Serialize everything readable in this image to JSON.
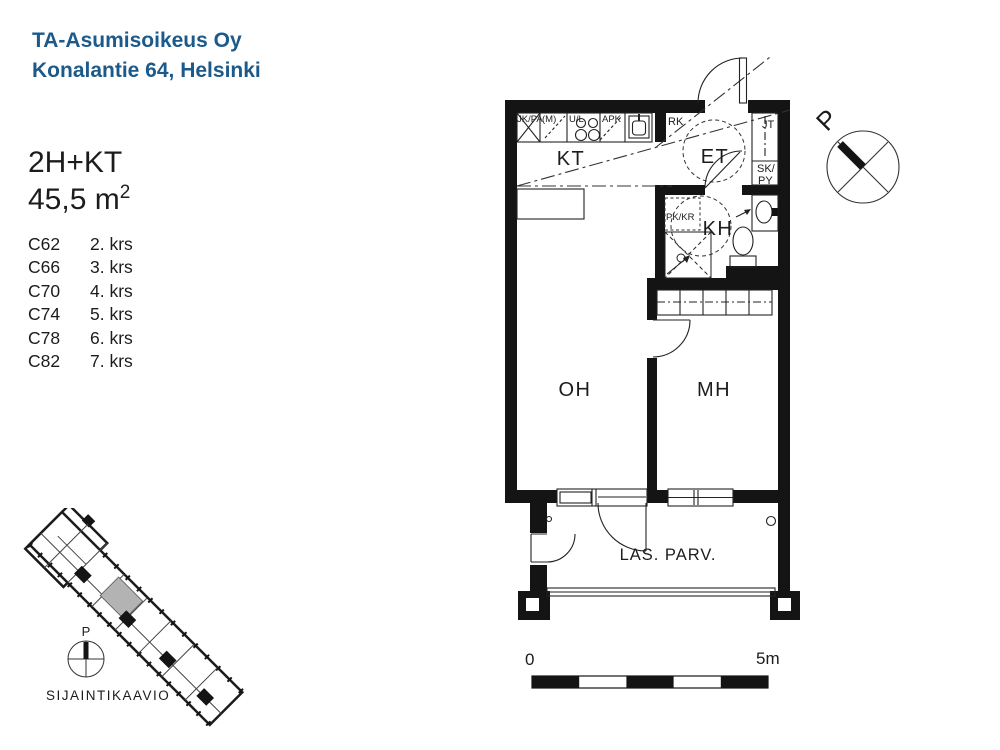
{
  "header": {
    "line1": "TA-Asumisoikeus Oy",
    "line2": "Konalantie 64, Helsinki"
  },
  "apartment": {
    "type": "2H+KT",
    "area_value": "45,5 m",
    "area_exponent": "2"
  },
  "units": [
    {
      "code": "C62",
      "floor": "2. krs"
    },
    {
      "code": "C66",
      "floor": "3. krs"
    },
    {
      "code": "C70",
      "floor": "4. krs"
    },
    {
      "code": "C74",
      "floor": "5. krs"
    },
    {
      "code": "C78",
      "floor": "6. krs"
    },
    {
      "code": "C82",
      "floor": "7. krs"
    }
  ],
  "floor_plan": {
    "room_labels": {
      "kitchen": "KT",
      "entry": "ET",
      "bathroom": "KH",
      "living": "OH",
      "bedroom": "MH",
      "balcony": "LAS. PARV."
    },
    "fixture_labels": {
      "fridge": "JK/PA",
      "microwave": "(M)",
      "stove": "U/L",
      "dishwasher": "APK",
      "electrical": "RK",
      "hall_closet": "JT",
      "cleaning_top": "SK/",
      "cleaning_bottom": "PY",
      "washer_reserve": "PK/KR"
    },
    "north_label": "P",
    "scale_bar": {
      "start": "0",
      "end": "5m"
    }
  },
  "site_map": {
    "north_label": "P",
    "caption": "SIJAINTIKAAVIO"
  },
  "colors": {
    "title_blue": "#1b5a8a",
    "plan_black": "#141414",
    "unit_gray": "#b3b3b3"
  }
}
